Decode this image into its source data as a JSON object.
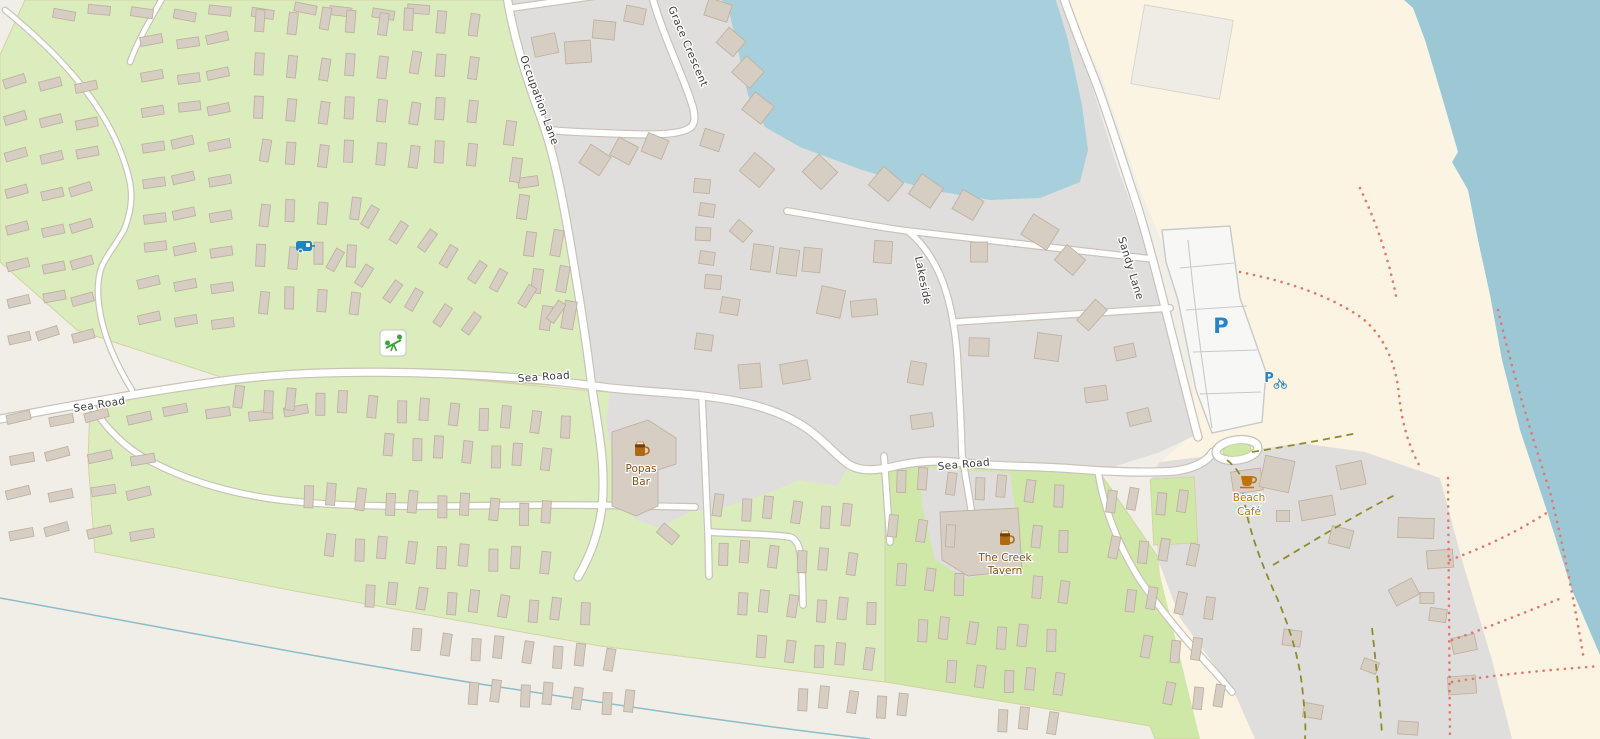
{
  "map": {
    "streets": {
      "occupation_lane": "Occupation Lane",
      "grace_crescent": "Grace Crescent",
      "sea_road": "Sea Road",
      "sandy_lane": "Sandy Lane",
      "lakeside": "Lakeside"
    },
    "pois": {
      "popas_bar": {
        "line1": "Popas",
        "line2": "Bar",
        "category": "pub"
      },
      "creek_tavern": {
        "line1": "The Creek",
        "line2": "Tavern",
        "category": "pub"
      },
      "beach_cafe": {
        "line1": "Beach",
        "line2": "Café",
        "category": "cafe"
      }
    },
    "markers": {
      "parking_letter": "P",
      "bike_parking_letter": "P"
    },
    "palette": {
      "base": "#f1eee8",
      "green_light": "#dcedbd",
      "green_grass": "#cfe8a8",
      "green_border": "#d2d3a2",
      "beach": "#fbf4e2",
      "gray": "#e0dedd",
      "bld": "#d6cec3",
      "bld_s": "#bfb1a1",
      "casing": "#c8c2b8",
      "water": "#a8d0dc",
      "sea": "#9cc8d6",
      "label": "#3c3c3c",
      "poi_brown": "#85511a",
      "poi_orange": "#bd730a",
      "blue": "#2884c7",
      "path_red": "#e2776c",
      "path_olive": "#8c8c2d",
      "stream": "#8cbcc8",
      "playground": "#3fa33c",
      "lot": "#f7f7f5",
      "lot_s": "#c9c9c9"
    }
  }
}
